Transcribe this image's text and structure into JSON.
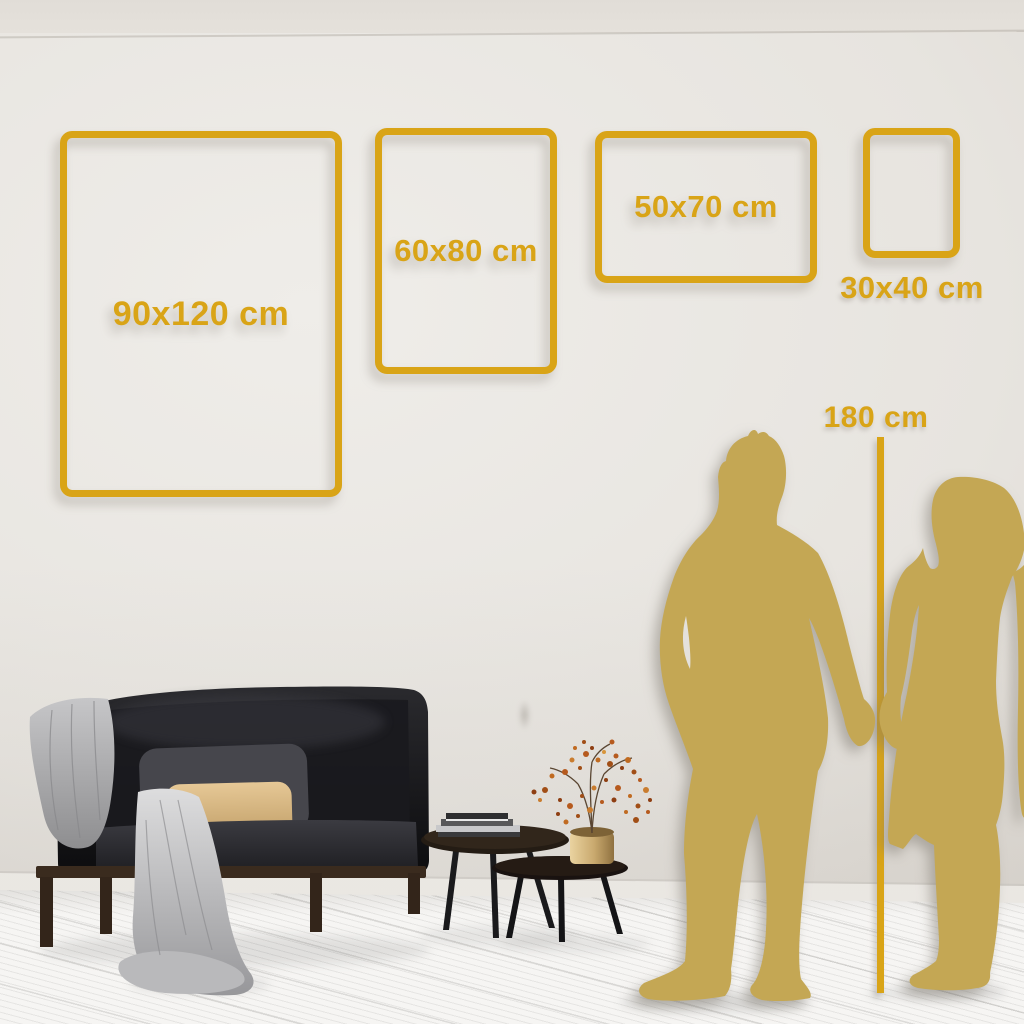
{
  "frames": {
    "items": [
      {
        "label": "90x120 cm"
      },
      {
        "label": "60x80 cm"
      },
      {
        "label": "50x70 cm"
      },
      {
        "label": "30x40 cm"
      }
    ]
  },
  "height_reference": {
    "label": "180 cm"
  },
  "colors": {
    "accent_gold": "#D9A417",
    "silhouette_gold": "#C4A754",
    "wall": "#E6E3DF",
    "floor": "#F5F4F2",
    "sofa_velvet": "#151518",
    "beige_pillow": "#D9B988",
    "blanket_gray": "#ABABAD",
    "vase_brass": "#C9A96E"
  },
  "scene_elements": [
    "sofa",
    "throw-blanket",
    "gray-pillow",
    "beige-pillow",
    "nesting-coffee-tables",
    "books-stack",
    "brass-vase",
    "dried-branch-with-berries",
    "man-silhouette",
    "woman-silhouette",
    "height-measure-line"
  ]
}
